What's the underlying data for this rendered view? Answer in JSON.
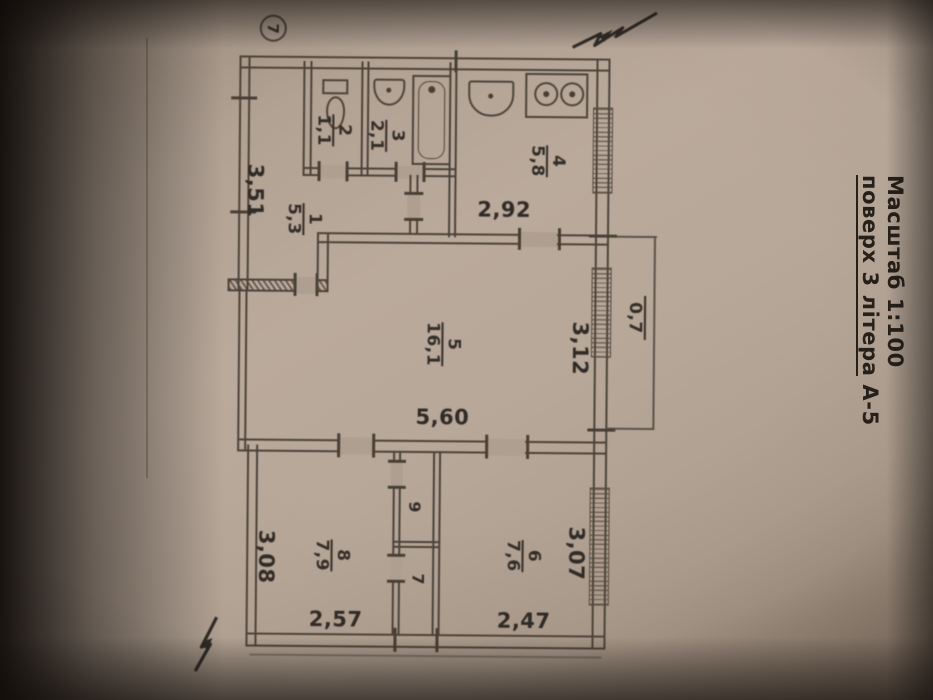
{
  "title_block": {
    "line1": "Масштаб 1:100",
    "line2_underlined": "поверх 3 літера",
    "line2_suffix": "А-5"
  },
  "apartment_badge": "7",
  "rooms": [
    {
      "number": "1",
      "area": "5,3"
    },
    {
      "number": "2",
      "area": "1,1"
    },
    {
      "number": "3",
      "area": "2,1"
    },
    {
      "number": "4",
      "area": "5,8"
    },
    {
      "number": "5",
      "area": "16,1"
    },
    {
      "number": "6",
      "area": "7,6"
    },
    {
      "number": "7",
      "area": ""
    },
    {
      "number": "8",
      "area": "7,9"
    },
    {
      "number": "9",
      "area": ""
    }
  ],
  "balcony": {
    "area": "0,7"
  },
  "dimensions": {
    "horizontal": [
      "2,92",
      "5,60",
      "2,57",
      "2,47"
    ],
    "vertical": [
      "3,51",
      "3,12",
      "3,07",
      "3,08"
    ]
  },
  "fixtures": [
    "toilet",
    "wash-basin",
    "bathtub",
    "kitchen-sink",
    "stove-2-burner"
  ],
  "colors": {
    "paper": "#b2a294",
    "ink": "#3a332c",
    "background": "#0b0806"
  }
}
